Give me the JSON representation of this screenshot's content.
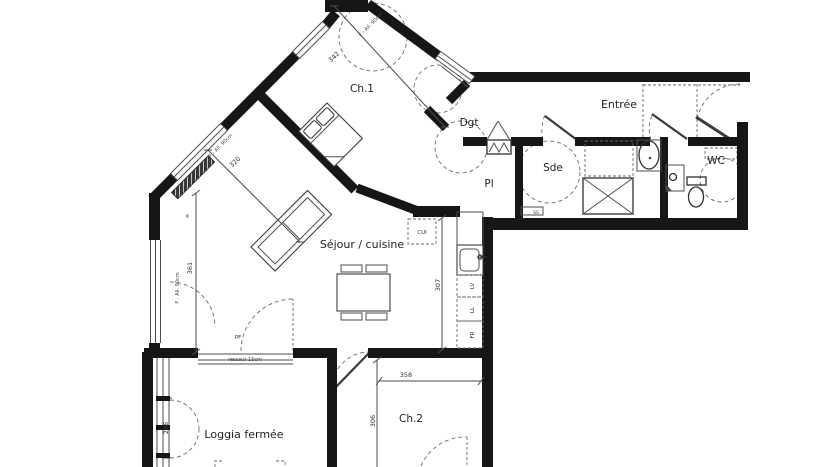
{
  "rooms": {
    "ch1": "Ch.1",
    "entree": "Entrée",
    "dgt": "Dgt",
    "pl": "Pl",
    "sde": "Sde",
    "wc": "WC",
    "sejour": "Séjour / cuisine",
    "ch2": "Ch.2",
    "loggia": "Loggia fermée"
  },
  "dims": {
    "d342": "342",
    "d320": "320",
    "d361": "361",
    "d307": "307",
    "d358": "358",
    "d306": "306",
    "d296": "296"
  },
  "windows": {
    "sill_note_a": "F - All. 90cm",
    "sill_note_b": "F - All. 90cm",
    "sill_note_c": "F - All. 90cm"
  },
  "annotations": {
    "pf": "PF",
    "ressaut": "ressaut 15cm",
    "radiator_mark": "✳"
  },
  "kitchen": {
    "cui": "CUI",
    "lv": "LV",
    "ll": "LL",
    "fr": "FR"
  },
  "bathroom": {
    "ss": "SS"
  },
  "colors": {
    "wall": "#161616",
    "thin_line": "#4d4d4d",
    "dashed_line": "#6a6a6a",
    "background": "#ffffff"
  }
}
